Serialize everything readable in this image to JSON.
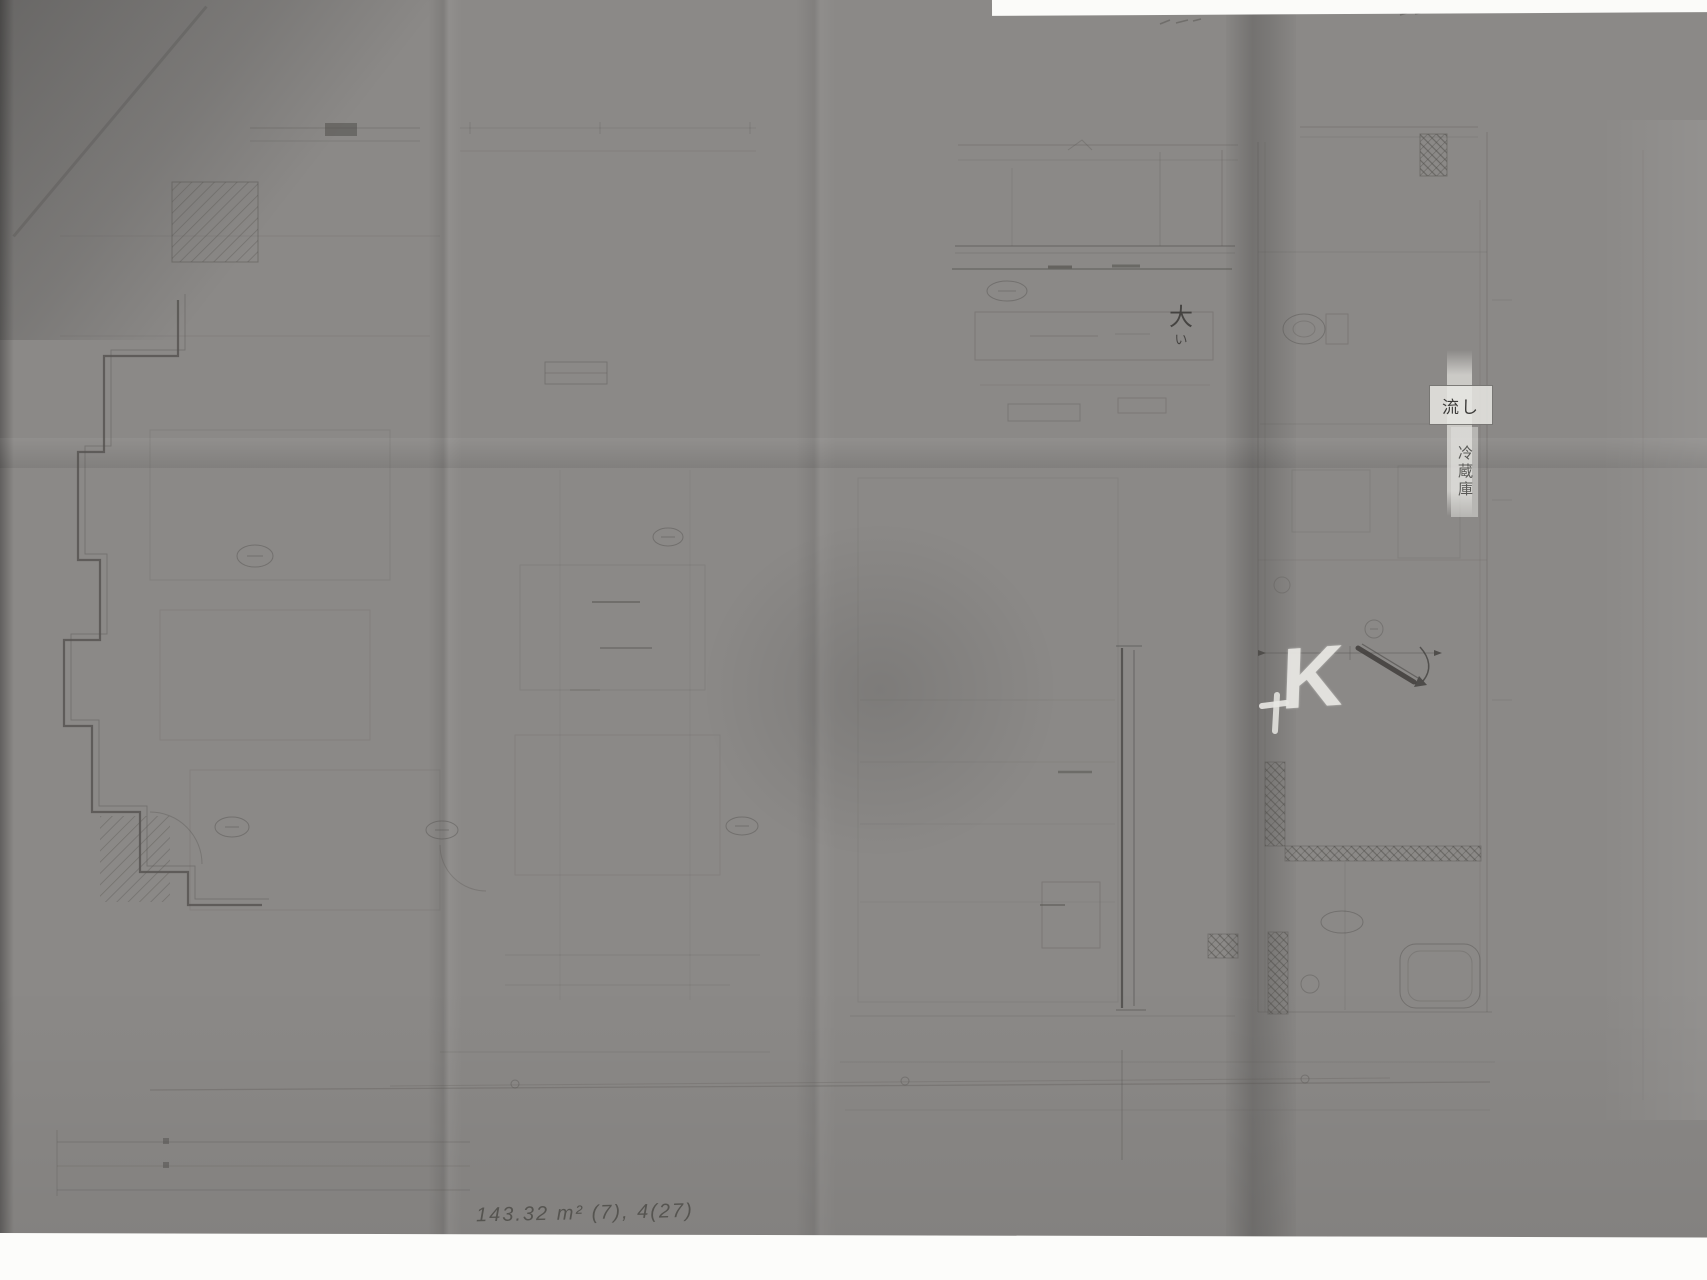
{
  "scene": {
    "type": "photograph",
    "subject": "hand-drawn architectural floor plan in pencil on a large folded sheet",
    "paper_color": "#8b8987",
    "shadow_color": "#6f6d6b",
    "pencil_color": "#55534f",
    "margin_color": "#fbfbf9",
    "correction_white": "#e8e7e3"
  },
  "labels": {
    "sink": "流し",
    "refrigerator": "冷蔵庫"
  },
  "annotations": {
    "paint_letter": "K",
    "kanji_note_top": "大",
    "kanji_note_bottom": "い",
    "area_note": "143.32 m² (7), 4(27)"
  }
}
